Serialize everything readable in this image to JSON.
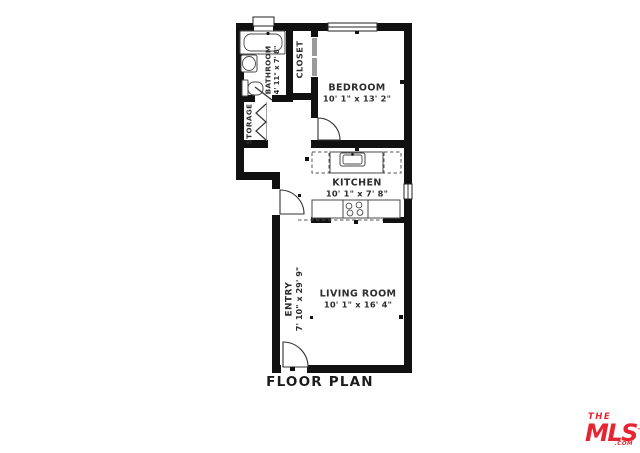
{
  "caption": "FLOOR PLAN",
  "rooms": {
    "bedroom": {
      "name": "BEDROOM",
      "dims": "10' 1\" x 13' 2\""
    },
    "kitchen": {
      "name": "KITCHEN",
      "dims": "10' 1\" x 7' 8\""
    },
    "living_room": {
      "name": "LIVING ROOM",
      "dims": "10' 1\" x 16' 4\""
    },
    "bathroom": {
      "name": "BATHROOM",
      "dims": "4' 11\" x 7' 8\""
    },
    "entry": {
      "name": "ENTRY",
      "dims": "7' 10\" x 29' 9\""
    },
    "closet": {
      "name": "CLOSET"
    },
    "storage": {
      "name": "STORAGE"
    }
  },
  "logo": {
    "line1": "THE",
    "line2": "MLS",
    "tm": "™",
    "suffix": ".COM"
  },
  "colors": {
    "wall": "#111111",
    "text": "#2d2d2d",
    "fixture_outline": "#4a4a4a",
    "logo_red": "#e62531",
    "background": "#ffffff"
  }
}
